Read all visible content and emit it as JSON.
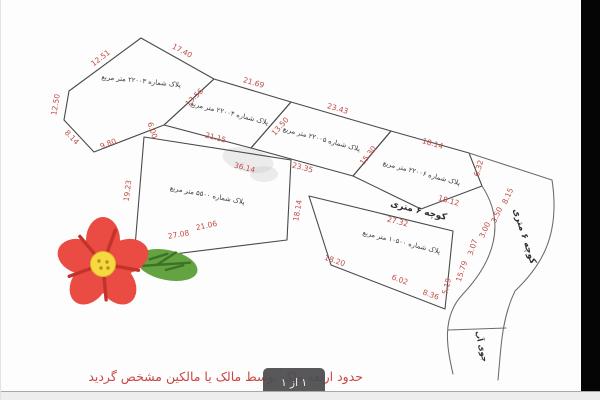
{
  "plan": {
    "m": [
      "12.51",
      "17.40",
      "12.50",
      "8.14",
      "9.80",
      "6.00",
      "13.56",
      "21.69",
      "21.15",
      "13.50",
      "23.43",
      "23.35",
      "15.30",
      "18.14",
      "6.32",
      "18.12",
      "8.15",
      "3.50",
      "3.00",
      "19.23",
      "36.14",
      "27.08",
      "18.14",
      "21.06",
      "27.32",
      "15.79",
      "3.07",
      "18.20",
      "6.02",
      "8.36",
      "5.19"
    ]
  },
  "plots": [
    {
      "label": "پلاک شماره ۲۲۰۰۳ متر مربع"
    },
    {
      "label": "پلاک شماره ۲۲۰۰۴ متر مربع"
    },
    {
      "label": "پلاک شماره ۲۲۰۰۵ متر مربع"
    },
    {
      "label": "پلاک شماره ۲۲۰۰۶ متر مربع"
    },
    {
      "label": "پلاک شماره ۵۵۰۰ متر مربع"
    },
    {
      "label": "پلاک شماره ۱۰۵۰۰ متر مربع"
    }
  ],
  "roads": {
    "alley_mid": "کوچه ۶ متری",
    "alley_right": "کوچه ۶ متری",
    "stream": "جوی آب"
  },
  "footer": {
    "note": "حدود اربعه ملک توسط مالک یا مالکین مشخص گردید",
    "page_indicator": "۱ از ۱"
  },
  "colors": {
    "measurement_red": "#c14b45",
    "note_red": "#cb4742",
    "line_gray": "#4a4a4a",
    "petal_red": "#ea4b42",
    "flower_center_yellow": "#f6d93f",
    "leaf_green": "#63a341"
  }
}
